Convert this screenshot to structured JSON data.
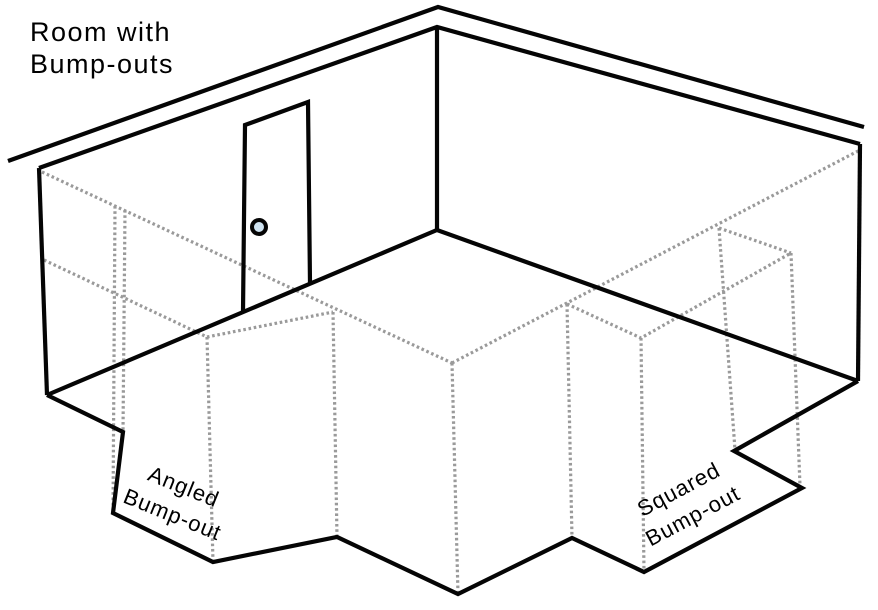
{
  "title": {
    "lines": [
      "Room with",
      "Bump-outs"
    ]
  },
  "labels": {
    "angled": {
      "lines": [
        "Angled",
        "Bump-out"
      ],
      "rotation_deg": 22,
      "center": {
        "x": 178,
        "y": 501
      }
    },
    "squared": {
      "lines": [
        "Squared",
        "Bump-out"
      ],
      "rotation_deg": -28,
      "center": {
        "x": 686,
        "y": 503
      }
    }
  },
  "colors": {
    "background": "#ffffff",
    "solid_line": "#050505",
    "dotted_line": "#9a9a9a",
    "text": "#000000",
    "door_knob_center": "#cfe3f1"
  },
  "diagram": {
    "canvas": {
      "width": 878,
      "height": 610
    },
    "solid_lines": [
      {
        "name": "ceiling-eave-line",
        "points": [
          [
            8,
            161
          ],
          [
            438,
            7
          ],
          [
            864,
            127
          ]
        ]
      },
      {
        "name": "wall-top-edge",
        "points": [
          [
            39,
            168
          ],
          [
            437,
            27
          ],
          [
            860,
            144
          ]
        ]
      },
      {
        "name": "wall-corner-post",
        "points": [
          [
            437,
            27
          ],
          [
            437,
            230
          ]
        ]
      },
      {
        "name": "left-wall-left-edge",
        "points": [
          [
            39,
            168
          ],
          [
            47,
            395
          ]
        ]
      },
      {
        "name": "right-wall-right-edge",
        "points": [
          [
            860,
            144
          ],
          [
            858,
            381
          ]
        ]
      },
      {
        "name": "wall-base-edge",
        "points": [
          [
            47,
            395
          ],
          [
            437,
            230
          ],
          [
            858,
            381
          ]
        ]
      },
      {
        "name": "floor-outline-with-bumpouts",
        "points": [
          [
            47,
            395
          ],
          [
            123,
            432
          ],
          [
            113,
            513
          ],
          [
            213,
            562
          ],
          [
            337,
            537
          ],
          [
            458,
            594
          ],
          [
            572,
            538
          ],
          [
            644,
            572
          ],
          [
            802,
            488
          ],
          [
            734,
            451
          ],
          [
            858,
            381
          ]
        ]
      },
      {
        "name": "door-frame",
        "points": [
          [
            243,
            312
          ],
          [
            245,
            125
          ],
          [
            308,
            102
          ],
          [
            310,
            284
          ]
        ]
      }
    ],
    "dotted_lines": [
      {
        "name": "floor-projection-left-edge",
        "points": [
          [
            42,
            172
          ],
          [
            452,
            363
          ]
        ]
      },
      {
        "name": "floor-projection-right-edge",
        "points": [
          [
            452,
            363
          ],
          [
            860,
            150
          ]
        ]
      },
      {
        "name": "angled-bumpout-base-edge",
        "points": [
          [
            44,
            260
          ],
          [
            207,
            337
          ],
          [
            333,
            312
          ]
        ]
      },
      {
        "name": "squared-bumpout-base-edge",
        "points": [
          [
            567,
            304
          ],
          [
            641,
            338
          ],
          [
            791,
            253
          ]
        ]
      },
      {
        "name": "squared-bumpout-top-edge",
        "points": [
          [
            719,
            228
          ],
          [
            791,
            253
          ]
        ]
      },
      {
        "name": "projection-line-1",
        "points": [
          [
            115,
            206
          ],
          [
            113,
            513
          ]
        ]
      },
      {
        "name": "projection-line-2",
        "points": [
          [
            125,
            210
          ],
          [
            123,
            432
          ]
        ]
      },
      {
        "name": "projection-line-3",
        "points": [
          [
            207,
            337
          ],
          [
            213,
            562
          ]
        ]
      },
      {
        "name": "projection-line-4",
        "points": [
          [
            333,
            312
          ],
          [
            337,
            537
          ]
        ]
      },
      {
        "name": "projection-line-5",
        "points": [
          [
            452,
            363
          ],
          [
            458,
            594
          ]
        ]
      },
      {
        "name": "projection-line-6",
        "points": [
          [
            567,
            304
          ],
          [
            572,
            538
          ]
        ]
      },
      {
        "name": "projection-line-7",
        "points": [
          [
            641,
            338
          ],
          [
            644,
            572
          ]
        ]
      },
      {
        "name": "projection-line-8",
        "points": [
          [
            719,
            228
          ],
          [
            735,
            450
          ]
        ]
      },
      {
        "name": "projection-line-9",
        "points": [
          [
            791,
            253
          ],
          [
            800,
            486
          ]
        ]
      }
    ],
    "door_knob": {
      "cx": 259,
      "cy": 227,
      "r": 7
    }
  }
}
